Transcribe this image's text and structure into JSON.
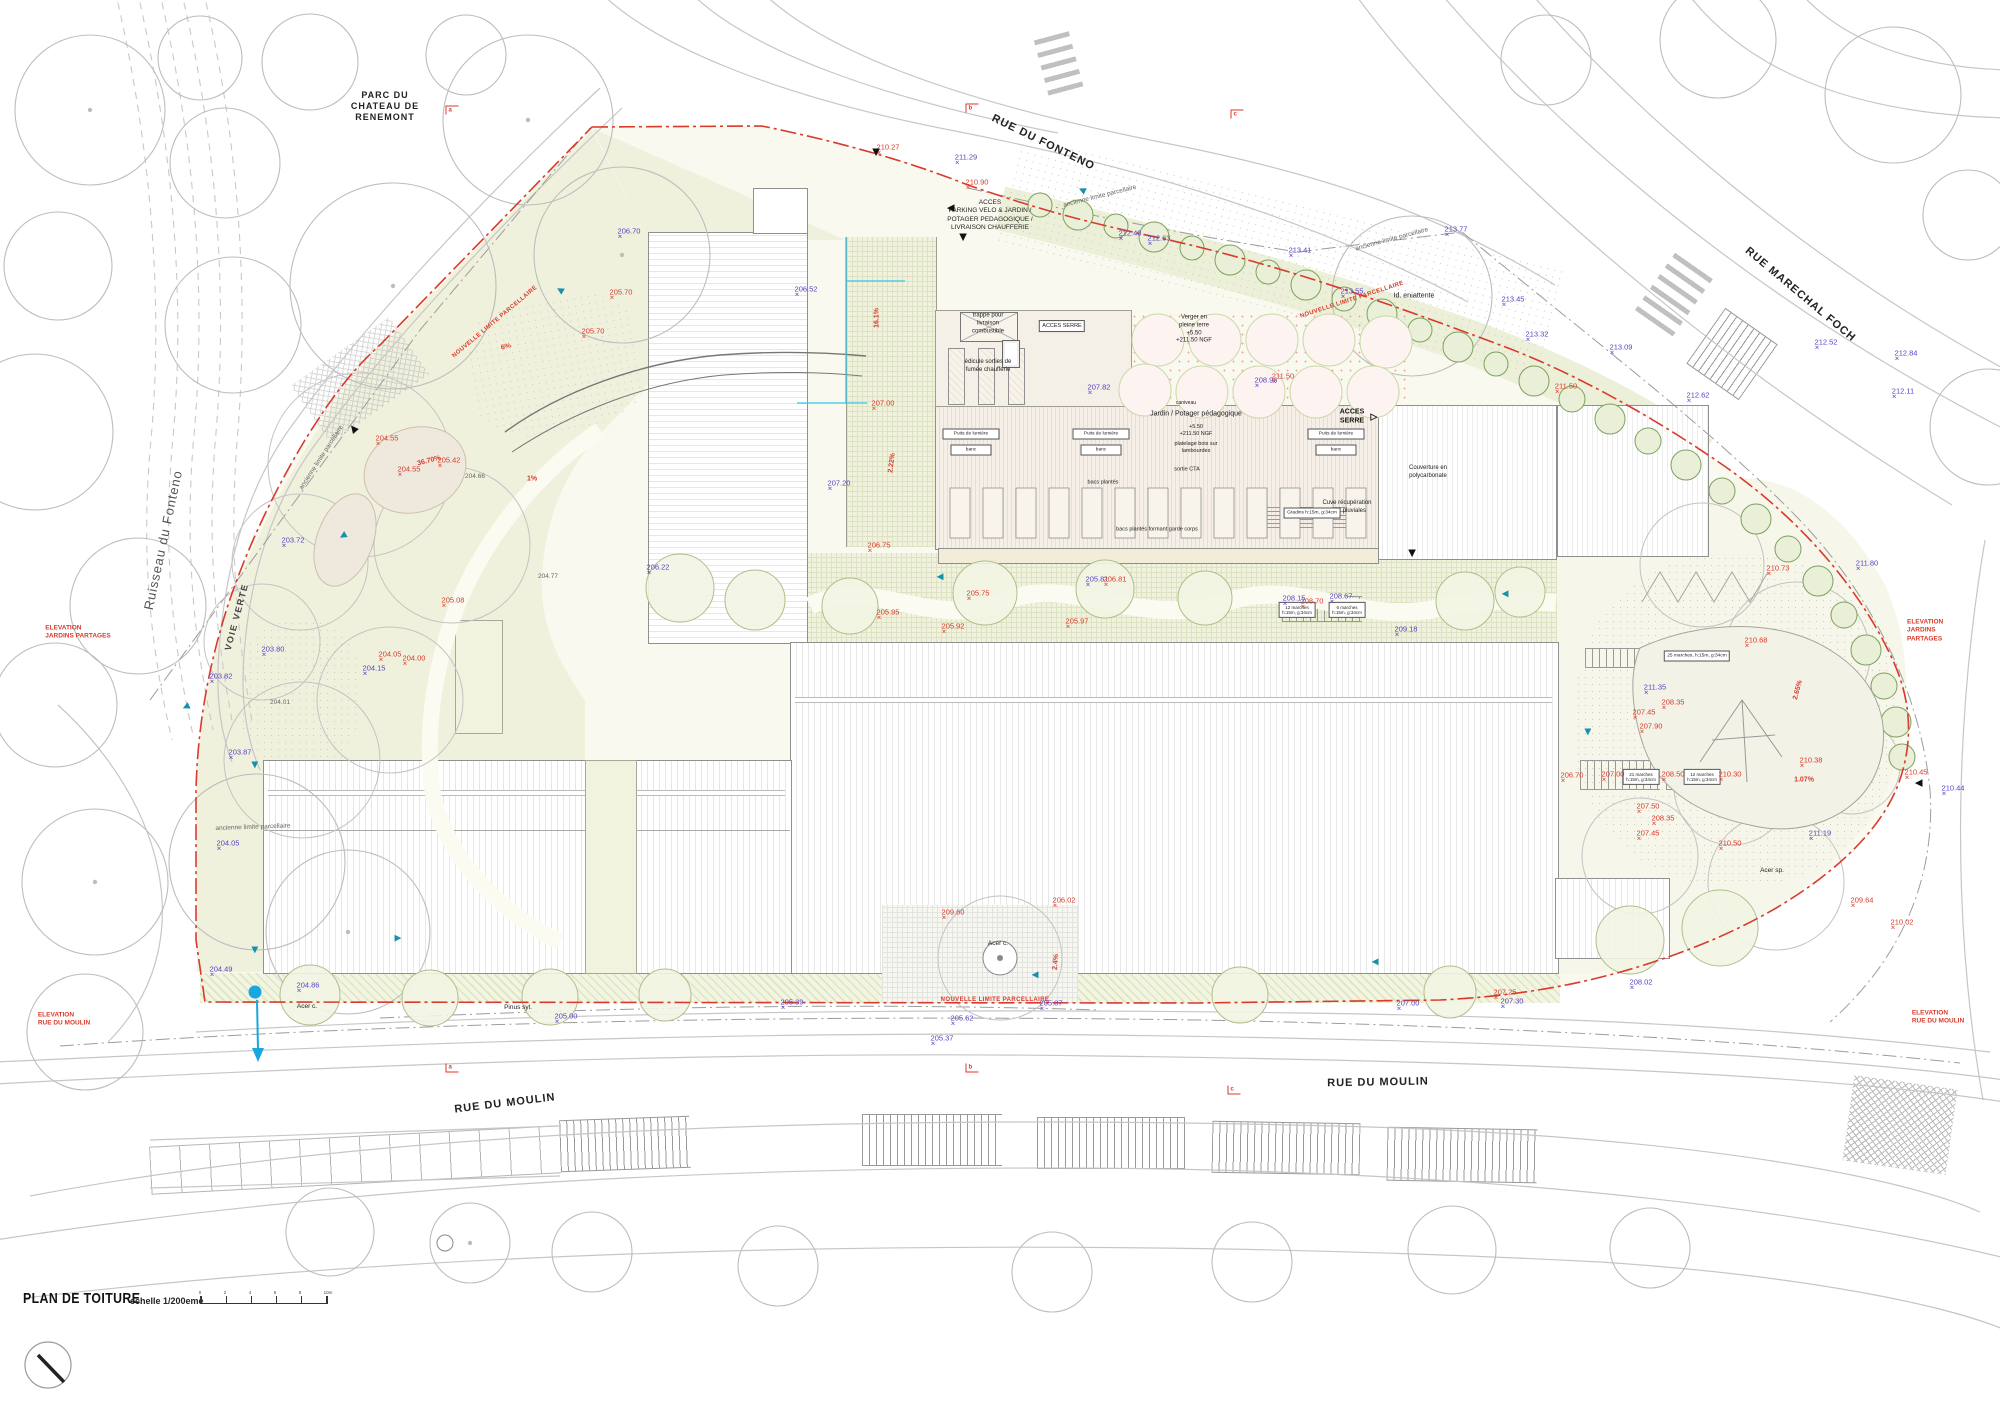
{
  "document": {
    "title": "PLAN DE TOITURE",
    "scale_label": "echelle 1/200eme",
    "drawing_type": "roof plan / site plan"
  },
  "symbols": {
    "entrance": "▲",
    "flow": "▶",
    "elev_marker": "✕",
    "open_triangle": "▷"
  },
  "colors": {
    "new_limit_red": "#d93a2b",
    "existing_elevation_purple": "#5b3fc4",
    "flow_teal": "#1691ac",
    "hedge_green": "#7da05e",
    "water_blue": "#18a8df"
  },
  "scale_ticks": [
    "0",
    "2",
    "4",
    "6",
    "8",
    "10m"
  ],
  "annotations": [
    {
      "t": "RUE DU FONTENO",
      "x": 1043,
      "y": 143,
      "c": "street",
      "r": 26,
      "n": "street-label-rue-du-fonteno"
    },
    {
      "t": "RUE MARECHAL FOCH",
      "x": 1800,
      "y": 295,
      "c": "street",
      "r": 40,
      "n": "street-label-rue-marechal-foch"
    },
    {
      "t": "RUE DU MOULIN",
      "x": 505,
      "y": 1104,
      "c": "street",
      "r": -7,
      "n": "street-label-rue-du-moulin-west"
    },
    {
      "t": "RUE DU MOULIN",
      "x": 1378,
      "y": 1083,
      "c": "street",
      "r": -1,
      "n": "street-label-rue-du-moulin-east"
    },
    {
      "t": "PARC DU\nCHATEAU DE\nRENEMONT",
      "x": 385,
      "y": 106,
      "c": "street",
      "fs": 9,
      "n": "park-label"
    },
    {
      "t": "Ruisseau du Fonteno",
      "x": 163,
      "y": 540,
      "c": "stream",
      "r": -78,
      "n": "stream-label"
    },
    {
      "t": "VOIE VERTE",
      "x": 237,
      "y": 617,
      "c": "voie",
      "r": -75,
      "n": "voie-verte-label"
    },
    {
      "t": "ELEVATION\nJARDINS PARTAGES",
      "x": 78,
      "y": 633,
      "c": "rnote",
      "n": "elevation-marker-jardins-west"
    },
    {
      "t": "ELEVATION\nJARDINS PARTAGES",
      "x": 1938,
      "y": 631,
      "c": "rnote",
      "n": "elevation-marker-jardins-east"
    },
    {
      "t": "ELEVATION\nRUE DU MOULIN",
      "x": 64,
      "y": 1020,
      "c": "rnote",
      "n": "elevation-marker-moulin-west"
    },
    {
      "t": "ELEVATION\nRUE DU MOULIN",
      "x": 1938,
      "y": 1018,
      "c": "rnote",
      "n": "elevation-marker-moulin-east"
    },
    {
      "t": "NOUVELLE LIMITE PARCELLAIRE",
      "x": 495,
      "y": 322,
      "c": "rlim",
      "r": -40
    },
    {
      "t": "NOUVELLE LIMITE PARCELLAIRE",
      "x": 1352,
      "y": 300,
      "c": "rlim",
      "r": -18
    },
    {
      "t": "NOUVELLE LIMITE PARCELLAIRE",
      "x": 995,
      "y": 1000,
      "c": "rlim",
      "r": 0
    },
    {
      "t": "ancienne limite parcellaire",
      "x": 322,
      "y": 458,
      "c": "gy",
      "r": -57
    },
    {
      "t": "ancienne limite parcellaire",
      "x": 1100,
      "y": 197,
      "c": "gy",
      "r": -14
    },
    {
      "t": "ancienne limite parcellaire",
      "x": 1392,
      "y": 240,
      "c": "gy",
      "r": -15
    },
    {
      "t": "ancienne limite parcellaire",
      "x": 253,
      "y": 828,
      "c": "gy",
      "r": -2
    },
    {
      "t": "204.66",
      "x": 475,
      "y": 477,
      "c": "gy"
    },
    {
      "t": "204.77",
      "x": 548,
      "y": 577,
      "c": "gy"
    },
    {
      "t": "204.01",
      "x": 280,
      "y": 703,
      "c": "gy"
    },
    {
      "t": "ACCES\nPARKING VELO & JARDIN /\nPOTAGER PEDAGOGIQUE /\nLIVRAISON CHAUFFERIE",
      "x": 990,
      "y": 216,
      "c": "note",
      "fs": 6.5
    },
    {
      "t": "Id. en attente",
      "x": 1414,
      "y": 296,
      "c": "note",
      "fs": 7
    },
    {
      "t": "trappe pour\nlivraison\ncombustible",
      "x": 988,
      "y": 324,
      "c": "note"
    },
    {
      "t": "édicule sorties de\nfumée chaufferie",
      "x": 988,
      "y": 367,
      "c": "note"
    },
    {
      "t": "Verger en\npleine terre\n+5.50\n+211.50 NGF",
      "x": 1194,
      "y": 330,
      "c": "note"
    },
    {
      "t": "Jardin / Potager pédagogique",
      "x": 1196,
      "y": 414,
      "c": "note",
      "fs": 7
    },
    {
      "t": "+5.50\n+211.50 NGF",
      "x": 1196,
      "y": 431,
      "c": "note",
      "fs": 5.5
    },
    {
      "t": "platelage bois sur\nlambourdes",
      "x": 1196,
      "y": 448,
      "c": "note",
      "fs": 5.5
    },
    {
      "t": "sortie CTA",
      "x": 1187,
      "y": 470,
      "c": "note",
      "fs": 5.5
    },
    {
      "t": "bacs plantés",
      "x": 1103,
      "y": 483,
      "c": "note",
      "fs": 5.5
    },
    {
      "t": "bacs plantés formant garde corps",
      "x": 1157,
      "y": 530,
      "c": "note",
      "fs": 5.5
    },
    {
      "t": "caniveau",
      "x": 1186,
      "y": 403,
      "c": "note",
      "fs": 5
    },
    {
      "t": "Couverture en\npolycarbonate",
      "x": 1428,
      "y": 473,
      "c": "note"
    },
    {
      "t": "Cuve récupération\neaux pluviales",
      "x": 1347,
      "y": 508,
      "c": "note"
    },
    {
      "t": "Acer c.",
      "x": 307,
      "y": 1007,
      "c": "note",
      "fs": 6.5
    },
    {
      "t": "Acer c.",
      "x": 998,
      "y": 944,
      "c": "note",
      "fs": 6.5
    },
    {
      "t": "Pinus syl.",
      "x": 518,
      "y": 1008,
      "c": "note",
      "fs": 6.5
    },
    {
      "t": "Acer sp.",
      "x": 1772,
      "y": 871,
      "c": "note",
      "fs": 6.5
    },
    {
      "t": "ACCES\nSERRE",
      "x": 1352,
      "y": 417,
      "c": "noteb"
    },
    {
      "t": "▷",
      "x": 1374,
      "y": 417,
      "c": "noteb",
      "fs": 9,
      "n": "triangle-right-icon"
    },
    {
      "t": "ACCES SERRE",
      "x": 1062,
      "y": 326,
      "c": "nbox",
      "fs": 5.5
    },
    {
      "t": "25 marches, h:15m, g:34cm",
      "x": 1697,
      "y": 656,
      "c": "nbox"
    },
    {
      "t": "21 marches\nh:15m, g:34cm",
      "x": 1641,
      "y": 777,
      "c": "nbox",
      "fs": 4.5
    },
    {
      "t": "12 marches\nh:15m, g:34cm",
      "x": 1702,
      "y": 777,
      "c": "nbox",
      "fs": 4.5
    },
    {
      "t": "Gradins h:15m, g:34cm",
      "x": 1312,
      "y": 513,
      "c": "nbox"
    },
    {
      "t": "12 marches\nh:15m, g:34cm",
      "x": 1297,
      "y": 610,
      "c": "nbox",
      "fs": 4.5
    },
    {
      "t": "6 marches\nh:15m, g:34cm",
      "x": 1347,
      "y": 610,
      "c": "nbox",
      "fs": 4.5
    },
    {
      "t": "Puits de lumière",
      "x": 971,
      "y": 434,
      "c": "nbox",
      "w": 50,
      "n": "light-well-label"
    },
    {
      "t": "banc",
      "x": 971,
      "y": 450,
      "c": "nbox",
      "w": 34
    },
    {
      "t": "Puits de lumière",
      "x": 1101,
      "y": 434,
      "c": "nbox",
      "w": 50,
      "n": "light-well-label"
    },
    {
      "t": "banc",
      "x": 1101,
      "y": 450,
      "c": "nbox",
      "w": 34
    },
    {
      "t": "Puits de lumière",
      "x": 1336,
      "y": 434,
      "c": "nbox",
      "w": 50,
      "n": "light-well-label"
    },
    {
      "t": "banc",
      "x": 1336,
      "y": 450,
      "c": "nbox",
      "w": 34
    },
    {
      "t": "211.29",
      "x": 966,
      "y": 160,
      "c": "ex"
    },
    {
      "t": "212.40",
      "x": 1130,
      "y": 236,
      "c": "ex"
    },
    {
      "t": "212.63",
      "x": 1159,
      "y": 241,
      "c": "ex"
    },
    {
      "t": "213.41",
      "x": 1300,
      "y": 253,
      "c": "ex"
    },
    {
      "t": "213.55",
      "x": 1352,
      "y": 294,
      "c": "ex"
    },
    {
      "t": "213.77",
      "x": 1456,
      "y": 232,
      "c": "ex"
    },
    {
      "t": "213.45",
      "x": 1513,
      "y": 302,
      "c": "ex"
    },
    {
      "t": "213.32",
      "x": 1537,
      "y": 337,
      "c": "ex"
    },
    {
      "t": "213.09",
      "x": 1621,
      "y": 350,
      "c": "ex"
    },
    {
      "t": "212.62",
      "x": 1698,
      "y": 398,
      "c": "ex"
    },
    {
      "t": "212.52",
      "x": 1826,
      "y": 345,
      "c": "ex"
    },
    {
      "t": "212.84",
      "x": 1906,
      "y": 356,
      "c": "ex"
    },
    {
      "t": "212.11",
      "x": 1903,
      "y": 394,
      "c": "ex"
    },
    {
      "t": "211.80",
      "x": 1867,
      "y": 566,
      "c": "ex"
    },
    {
      "t": "210.44",
      "x": 1953,
      "y": 791,
      "c": "ex"
    },
    {
      "t": "211.19",
      "x": 1820,
      "y": 836,
      "c": "ex"
    },
    {
      "t": "208.02",
      "x": 1641,
      "y": 985,
      "c": "ex"
    },
    {
      "t": "207.30",
      "x": 1512,
      "y": 1004,
      "c": "ex"
    },
    {
      "t": "207.00",
      "x": 1408,
      "y": 1006,
      "c": "ex"
    },
    {
      "t": "205.87",
      "x": 1051,
      "y": 1006,
      "c": "ex"
    },
    {
      "t": "205.62",
      "x": 962,
      "y": 1021,
      "c": "ex"
    },
    {
      "t": "205.37",
      "x": 942,
      "y": 1041,
      "c": "ex"
    },
    {
      "t": "205.39",
      "x": 792,
      "y": 1005,
      "c": "ex"
    },
    {
      "t": "205.00",
      "x": 566,
      "y": 1019,
      "c": "ex"
    },
    {
      "t": "204.86",
      "x": 308,
      "y": 988,
      "c": "ex"
    },
    {
      "t": "204.49",
      "x": 221,
      "y": 972,
      "c": "ex"
    },
    {
      "t": "204.05",
      "x": 228,
      "y": 846,
      "c": "ex"
    },
    {
      "t": "203.87",
      "x": 240,
      "y": 755,
      "c": "ex"
    },
    {
      "t": "203.82",
      "x": 221,
      "y": 679,
      "c": "ex"
    },
    {
      "t": "203.80",
      "x": 273,
      "y": 652,
      "c": "ex"
    },
    {
      "t": "203.72",
      "x": 293,
      "y": 543,
      "c": "ex"
    },
    {
      "t": "204.15",
      "x": 374,
      "y": 671,
      "c": "ex"
    },
    {
      "t": "206.70",
      "x": 629,
      "y": 234,
      "c": "ex"
    },
    {
      "t": "206.52",
      "x": 806,
      "y": 292,
      "c": "ex"
    },
    {
      "t": "207.20",
      "x": 839,
      "y": 486,
      "c": "ex"
    },
    {
      "t": "207.82",
      "x": 1099,
      "y": 390,
      "c": "ex"
    },
    {
      "t": "208.96",
      "x": 1266,
      "y": 383,
      "c": "ex"
    },
    {
      "t": "208.67",
      "x": 1341,
      "y": 599,
      "c": "ex"
    },
    {
      "t": "208.15",
      "x": 1294,
      "y": 601,
      "c": "ex"
    },
    {
      "t": "209.18",
      "x": 1406,
      "y": 632,
      "c": "ex"
    },
    {
      "t": "205.81",
      "x": 1097,
      "y": 582,
      "c": "ex"
    },
    {
      "t": "206.22",
      "x": 658,
      "y": 570,
      "c": "ex"
    },
    {
      "t": "211.35",
      "x": 1655,
      "y": 690,
      "c": "ex"
    },
    {
      "t": "210.27",
      "x": 888,
      "y": 150,
      "c": "nw"
    },
    {
      "t": "210.90",
      "x": 977,
      "y": 185,
      "c": "nw"
    },
    {
      "t": "211.50",
      "x": 1283,
      "y": 379,
      "c": "nw"
    },
    {
      "t": "211.50",
      "x": 1566,
      "y": 389,
      "c": "nw"
    },
    {
      "t": "205.70",
      "x": 621,
      "y": 295,
      "c": "nw"
    },
    {
      "t": "205.70",
      "x": 593,
      "y": 334,
      "c": "nw"
    },
    {
      "t": "207.00",
      "x": 883,
      "y": 406,
      "c": "nw"
    },
    {
      "t": "206.75",
      "x": 879,
      "y": 548,
      "c": "nw"
    },
    {
      "t": "204.55",
      "x": 387,
      "y": 441,
      "c": "nw"
    },
    {
      "t": "204.55",
      "x": 409,
      "y": 472,
      "c": "nw"
    },
    {
      "t": "205.42",
      "x": 449,
      "y": 463,
      "c": "nw"
    },
    {
      "t": "204.05",
      "x": 390,
      "y": 657,
      "c": "nw"
    },
    {
      "t": "204.00",
      "x": 414,
      "y": 661,
      "c": "nw"
    },
    {
      "t": "205.08",
      "x": 453,
      "y": 603,
      "c": "nw"
    },
    {
      "t": "205.95",
      "x": 888,
      "y": 615,
      "c": "nw"
    },
    {
      "t": "205.75",
      "x": 978,
      "y": 596,
      "c": "nw"
    },
    {
      "t": "205.92",
      "x": 953,
      "y": 629,
      "c": "nw"
    },
    {
      "t": "205.97",
      "x": 1077,
      "y": 624,
      "c": "nw"
    },
    {
      "t": "206.81",
      "x": 1115,
      "y": 582,
      "c": "nw"
    },
    {
      "t": "208.70",
      "x": 1312,
      "y": 604,
      "c": "nw"
    },
    {
      "t": "209.60",
      "x": 953,
      "y": 915,
      "c": "nw"
    },
    {
      "t": "206.02",
      "x": 1064,
      "y": 903,
      "c": "nw"
    },
    {
      "t": "207.25",
      "x": 1505,
      "y": 995,
      "c": "nw"
    },
    {
      "t": "210.73",
      "x": 1778,
      "y": 571,
      "c": "nw"
    },
    {
      "t": "210.68",
      "x": 1756,
      "y": 643,
      "c": "nw"
    },
    {
      "t": "208.35",
      "x": 1673,
      "y": 705,
      "c": "nw"
    },
    {
      "t": "207.45",
      "x": 1644,
      "y": 715,
      "c": "nw"
    },
    {
      "t": "207.90",
      "x": 1651,
      "y": 729,
      "c": "nw"
    },
    {
      "t": "206.70",
      "x": 1572,
      "y": 778,
      "c": "nw"
    },
    {
      "t": "207.00",
      "x": 1613,
      "y": 777,
      "c": "nw"
    },
    {
      "t": "208.50",
      "x": 1673,
      "y": 777,
      "c": "nw"
    },
    {
      "t": "210.30",
      "x": 1730,
      "y": 777,
      "c": "nw"
    },
    {
      "t": "210.38",
      "x": 1811,
      "y": 763,
      "c": "nw"
    },
    {
      "t": "210.45",
      "x": 1916,
      "y": 775,
      "c": "nw"
    },
    {
      "t": "207.50",
      "x": 1648,
      "y": 809,
      "c": "nw"
    },
    {
      "t": "208.35",
      "x": 1663,
      "y": 821,
      "c": "nw"
    },
    {
      "t": "207.45",
      "x": 1648,
      "y": 836,
      "c": "nw"
    },
    {
      "t": "210.50",
      "x": 1730,
      "y": 846,
      "c": "nw"
    },
    {
      "t": "209.64",
      "x": 1862,
      "y": 903,
      "c": "nw"
    },
    {
      "t": "210.02",
      "x": 1902,
      "y": 925,
      "c": "nw"
    },
    {
      "t": "6%",
      "x": 506,
      "y": 347,
      "c": "sl",
      "r": -15
    },
    {
      "t": "16.1%",
      "x": 877,
      "y": 318,
      "c": "sl",
      "r": -90
    },
    {
      "t": "2.22%",
      "x": 892,
      "y": 463,
      "c": "sl",
      "r": -83
    },
    {
      "t": "2.4%",
      "x": 1056,
      "y": 962,
      "c": "sl",
      "r": -85
    },
    {
      "t": "1%",
      "x": 532,
      "y": 479,
      "c": "sl"
    },
    {
      "t": "36.70%",
      "x": 429,
      "y": 461,
      "c": "sl",
      "r": -15
    },
    {
      "t": "1.07%",
      "x": 1804,
      "y": 780,
      "c": "sl"
    },
    {
      "t": "2.65%",
      "x": 1798,
      "y": 690,
      "c": "sl",
      "r": -75
    },
    {
      "t": "a",
      "x": 452,
      "y": 110,
      "c": "secT",
      "n": "section-marker-a-top"
    },
    {
      "t": "b",
      "x": 972,
      "y": 108,
      "c": "secT",
      "n": "section-marker-b-top"
    },
    {
      "t": "c",
      "x": 1237,
      "y": 114,
      "c": "secT",
      "n": "section-marker-c-top"
    },
    {
      "t": "a",
      "x": 452,
      "y": 1068,
      "c": "secB",
      "n": "section-marker-a-bottom"
    },
    {
      "t": "b",
      "x": 972,
      "y": 1068,
      "c": "secB",
      "n": "section-marker-b-bottom"
    },
    {
      "t": "c",
      "x": 1234,
      "y": 1090,
      "c": "secB",
      "n": "section-marker-c-bottom"
    },
    {
      "t": "0",
      "x": 200,
      "y": 1293,
      "c": "tick"
    },
    {
      "t": "2",
      "x": 225,
      "y": 1293,
      "c": "tick"
    },
    {
      "t": "4",
      "x": 250,
      "y": 1293,
      "c": "tick"
    },
    {
      "t": "6",
      "x": 275,
      "y": 1293,
      "c": "tick"
    },
    {
      "t": "8",
      "x": 300,
      "y": 1293,
      "c": "tick"
    },
    {
      "t": "10m",
      "x": 328,
      "y": 1293,
      "c": "tick"
    }
  ],
  "icons": {
    "entrances": [
      {
        "x": 876,
        "y": 153,
        "r": 180
      },
      {
        "x": 963,
        "y": 238,
        "r": 180
      },
      {
        "x": 950,
        "y": 208,
        "r": -90
      },
      {
        "x": 353,
        "y": 428,
        "r": -40
      },
      {
        "x": 1412,
        "y": 554,
        "r": 180
      },
      {
        "x": 1918,
        "y": 783,
        "r": -90
      }
    ],
    "flow_arrows": [
      {
        "x": 560,
        "y": 290,
        "r": 210
      },
      {
        "x": 343,
        "y": 536,
        "r": 150
      },
      {
        "x": 186,
        "y": 707,
        "r": 155
      },
      {
        "x": 398,
        "y": 938,
        "r": 0
      },
      {
        "x": 940,
        "y": 577,
        "r": 180
      },
      {
        "x": 1505,
        "y": 594,
        "r": 180
      },
      {
        "x": 1588,
        "y": 732,
        "r": 90
      },
      {
        "x": 1035,
        "y": 975,
        "r": 180
      },
      {
        "x": 1375,
        "y": 962,
        "r": 180
      },
      {
        "x": 255,
        "y": 765,
        "r": 90
      },
      {
        "x": 255,
        "y": 950,
        "r": 90
      },
      {
        "x": 1082,
        "y": 190,
        "r": 205
      }
    ],
    "water_point": {
      "x": 255,
      "y": 992
    }
  }
}
